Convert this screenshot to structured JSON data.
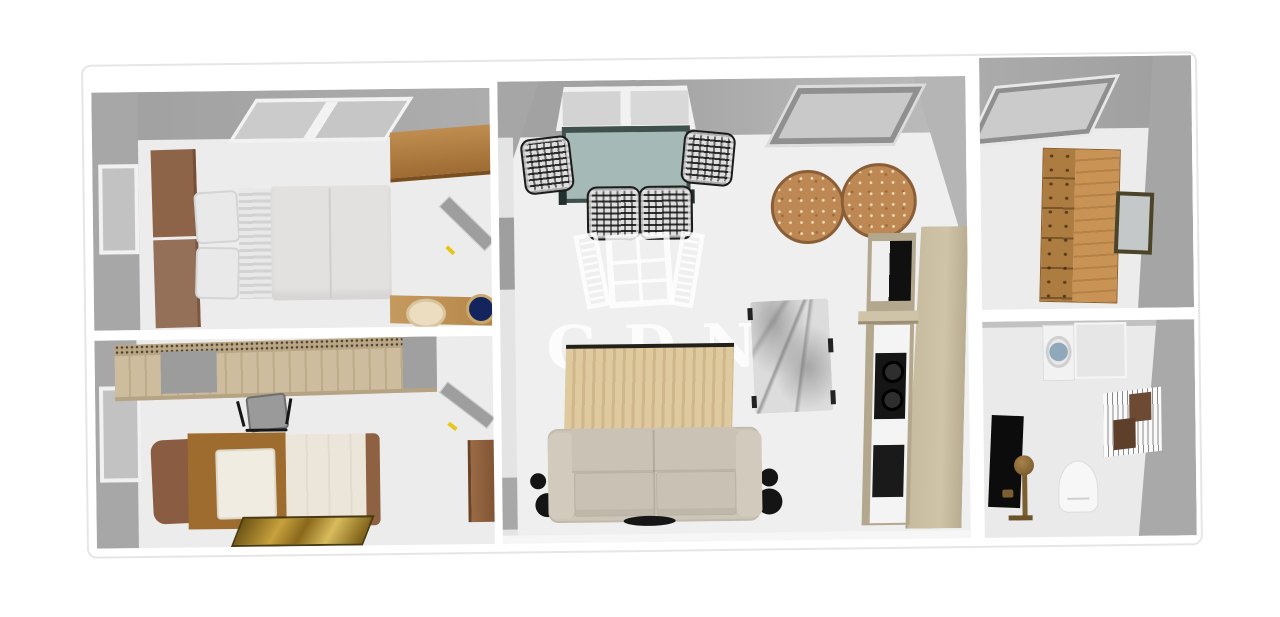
{
  "watermark": {
    "text": "GDN",
    "logo_icon": "open-window-shutters-icon"
  },
  "scene": {
    "type": "3d-floor-plan-top-view",
    "rooms": [
      {
        "name": "bedroom-double",
        "items": [
          "double-bed",
          "brown-headboard",
          "pillows",
          "striped-sheet",
          "wall-shelf",
          "side-bench",
          "sun-hat",
          "navy-bowl",
          "left-window",
          "top-window",
          "open-door"
        ]
      },
      {
        "name": "bedroom-single",
        "items": [
          "wardrobe-desk",
          "office-chair",
          "single-bed",
          "white-pillow",
          "cream-duvet",
          "gold-rug",
          "side-cabinet",
          "left-window",
          "open-door"
        ]
      },
      {
        "name": "living-dining-room",
        "items": [
          "dining-table",
          "rattan-chair",
          "rattan-chair",
          "rattan-chair",
          "rattan-chair",
          "top-window",
          "skylight",
          "round-jute-rug",
          "round-jute-rug",
          "striped-area-rug",
          "sofa",
          "floor-lamp",
          "floor-lamp",
          "marble-table",
          "kitchen-tall-unit",
          "floor-grille"
        ]
      },
      {
        "name": "dressing-room",
        "items": [
          "skylight",
          "wooden-dresser",
          "wall-picture"
        ]
      },
      {
        "name": "bathroom",
        "items": [
          "washing-machine",
          "counter",
          "towel-rack",
          "toilet",
          "black-shower-panel",
          "brass-shower-set"
        ]
      }
    ]
  },
  "palette": {
    "background": "#ffffff",
    "wall_gray": "#a7a7a7",
    "wall_gray_light": "#b8b8b8",
    "floor": "#ececec",
    "oak_wood": "#c08b4e",
    "light_wood": "#cdbc9d",
    "brown_leather": "#8e6449",
    "bed_linen": "#e2e1df",
    "cream_duvet": "#ebe5da",
    "table_teal": "#a5bab6",
    "table_frame": "#3f504d",
    "jute": "#bd8853",
    "area_rug": "#dfc99f",
    "gold_rug": "#c7a13d",
    "sofa_beige": "#cdc6b8",
    "marble": "#dcdcdc",
    "unit_greige": "#b3a78d",
    "appliance_black": "#151515",
    "brass": "#8c6b36",
    "door_handle_yellow": "#e6c619",
    "bowl_navy": "#14255d",
    "watermark_color": "rgba(255,255,255,0.8)"
  }
}
